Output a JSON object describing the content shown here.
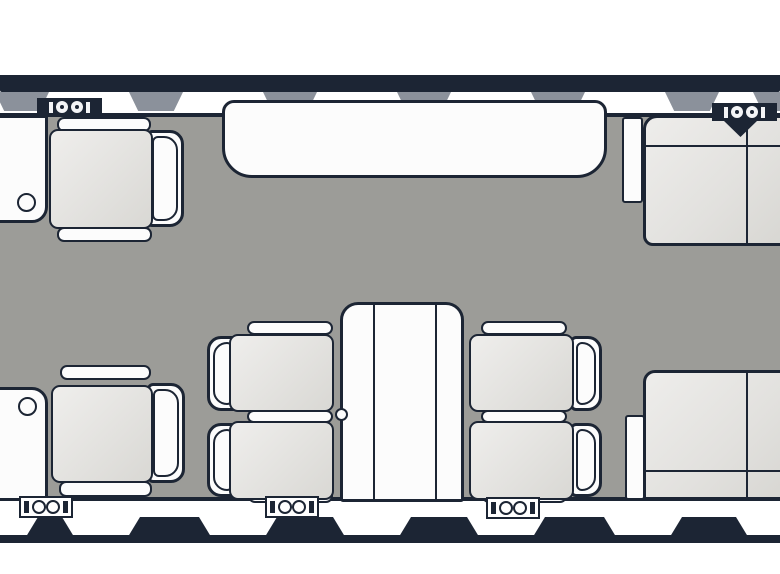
{
  "diagram": {
    "type": "aircraft-cabin-floorplan",
    "view": "top-down",
    "description": "Top-down floor plan of a business jet cabin with club seats, a three-place divan, two two-place sofas, side cabinets with cupholders, and a folding conference table",
    "colors": {
      "outline_navy": "#1c2534",
      "floor_gray": "#9c9c98",
      "window_gray": "#8b919b",
      "cushion_gray": "#e3e2df",
      "furniture_white": "#fcfcfc",
      "background": "#ffffff"
    },
    "windows": {
      "top_row_count": 7,
      "bottom_row_count": 7
    },
    "furniture": [
      {
        "id": "forward-left-cabinet",
        "kind": "side cabinet with cupholder"
      },
      {
        "id": "forward-left-club-seat",
        "kind": "single club seat",
        "facing": "left"
      },
      {
        "id": "divan",
        "kind": "three-place divan",
        "wall": "top"
      },
      {
        "id": "aft-left-cabinet",
        "kind": "side cabinet with cupholder"
      },
      {
        "id": "aft-left-club-seat",
        "kind": "single club seat",
        "facing": "left"
      },
      {
        "id": "conference-table",
        "kind": "folding conference table"
      },
      {
        "id": "club-seat-left-top",
        "kind": "single club seat",
        "facing": "right"
      },
      {
        "id": "club-seat-left-bottom",
        "kind": "single club seat",
        "facing": "right"
      },
      {
        "id": "club-seat-right-top",
        "kind": "single club seat",
        "facing": "left"
      },
      {
        "id": "club-seat-right-bottom",
        "kind": "single club seat",
        "facing": "left"
      },
      {
        "id": "sofa-top-right",
        "kind": "two-place sofa",
        "facing": "down"
      },
      {
        "id": "sofa-bottom-right",
        "kind": "two-place sofa",
        "facing": "up"
      },
      {
        "id": "side-ledge-top-right",
        "kind": "side ledge"
      },
      {
        "id": "side-ledge-bottom-right",
        "kind": "side ledge"
      }
    ],
    "markers": {
      "double_circle_top": 2,
      "double_circle_bottom": 3,
      "triangle": 1
    }
  }
}
